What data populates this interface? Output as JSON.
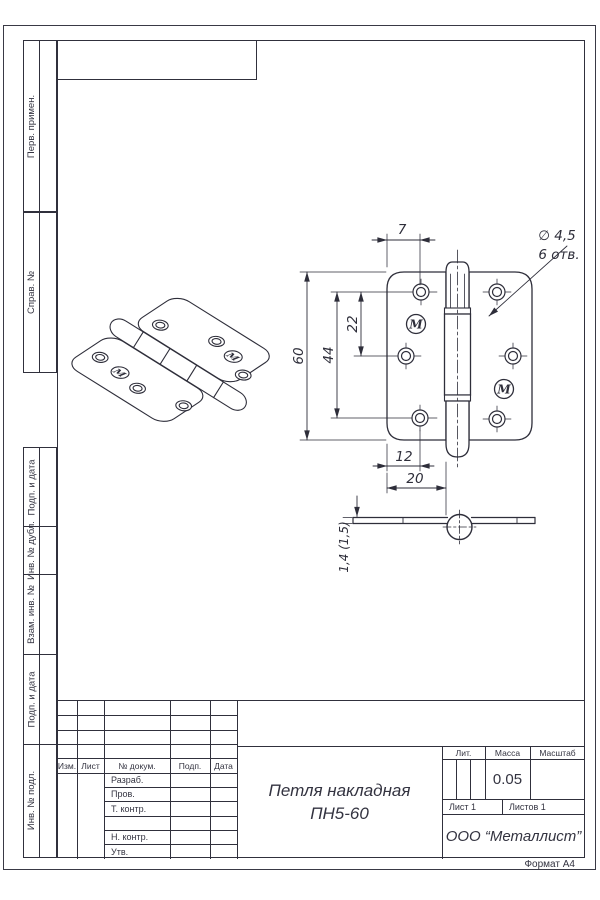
{
  "page": {
    "format": "Формат А4"
  },
  "sidebar": {
    "top_labels": [
      "Перв. примен.",
      "Справ. №"
    ],
    "bottom_labels": [
      "Подп. и дата",
      "Инв. № дубл.",
      "Взам. инв. №",
      "Подп. и дата",
      "Инв. № подл."
    ]
  },
  "views": {
    "logo_letter": "М",
    "dims": {
      "top_offset": "7",
      "dia_callout": "∅ 4,5",
      "dia_count": "6 отв.",
      "height": "60",
      "span_outer": "44",
      "span_inner": "22",
      "bottom_offset": "12",
      "leaf_width": "20",
      "thickness": "1,4 (1,5)"
    }
  },
  "title_block": {
    "headers": {
      "izm": "Изм.",
      "list": "Лист",
      "doc": "№ докум.",
      "podp": "Подп.",
      "data": "Дата"
    },
    "roles": [
      "Разраб.",
      "Пров.",
      "Т. контр.",
      "Н. контр.",
      "Утв."
    ],
    "title_line1": "Петля накладная",
    "title_line2": "ПН5-60",
    "lit": "Лит.",
    "mass": "Масса",
    "scale": "Масштаб",
    "mass_value": "0.05",
    "sheet": "Лист 1",
    "sheets": "Листов 1",
    "company": "ООО “Металлист”"
  }
}
